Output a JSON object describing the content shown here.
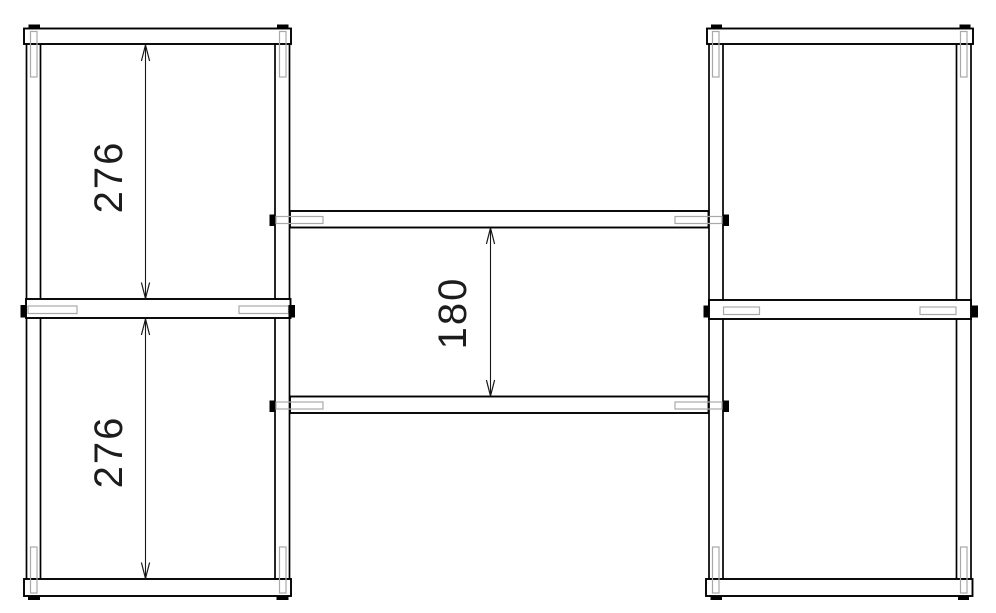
{
  "drawing": {
    "kind": "technical-drawing",
    "description": "Frame assembly elevation: two side frames joined by two cross rails, with three vertical dimensions",
    "colors": {
      "background": "#ffffff",
      "line": "#000000",
      "detail_line": "#a9a9a9",
      "text": "#1c1c1c"
    },
    "dimensions": {
      "upper_left_bay_height": "276",
      "lower_left_bay_height": "276",
      "cross_rail_clearance": "180"
    }
  }
}
